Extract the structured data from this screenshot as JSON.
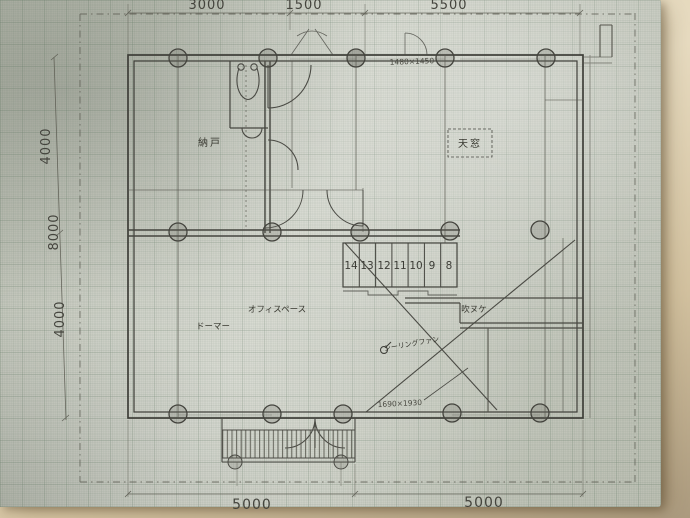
{
  "dimensions": {
    "top": [
      "3000",
      "1500",
      "5500"
    ],
    "left": [
      "4000",
      "8000",
      "4000"
    ],
    "bottom": [
      "5000",
      "5000"
    ]
  },
  "labels": {
    "storage": "納戸",
    "skylight": "天窓",
    "office_space": "オフィスペース",
    "dormer": "ドーマー",
    "void": "吹ヌケ",
    "ceiling_fan": "シーリングファン"
  },
  "stairs": {
    "numbers": [
      "14",
      "13",
      "12",
      "11",
      "10",
      "9",
      "8"
    ]
  },
  "annotations": {
    "window_top": "1480×1450",
    "window_bottom": "1690×1930"
  },
  "colors": {
    "paper": "#c6c9bd",
    "grid_line": "#6e8270",
    "pencil": "#45453f",
    "mat": "#d9cbae"
  }
}
